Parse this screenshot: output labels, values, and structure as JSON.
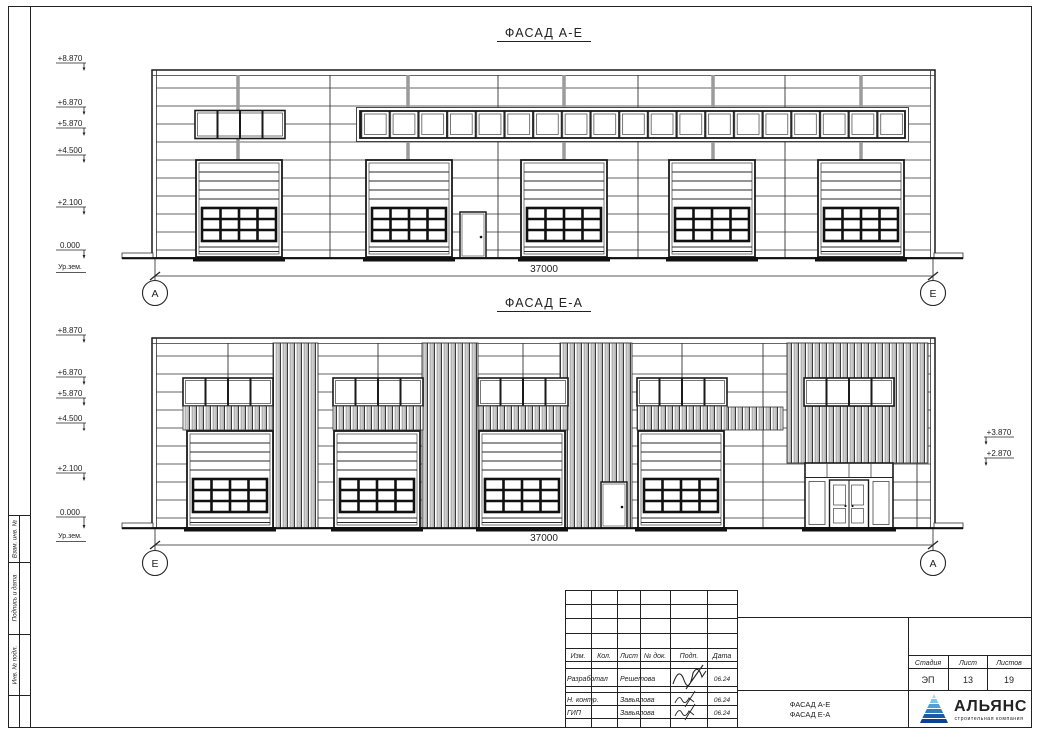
{
  "sheet": {
    "side_labels": [
      "Взам. инв. №",
      "Подпись и дата",
      "Инв. № подл."
    ]
  },
  "facade_top": {
    "title": "ФАСАД А-Е",
    "dimension": "37000",
    "axis_left": "А",
    "axis_right": "Е",
    "ground_label": "Ур.зем.",
    "marks": [
      "+8.870",
      "+6.870",
      "+5.870",
      "+4.500",
      "+2.100",
      "0.000"
    ]
  },
  "facade_bottom": {
    "title": "ФАСАД Е-А",
    "dimension": "37000",
    "axis_left": "Е",
    "axis_right": "А",
    "ground_label": "Ур.зем.",
    "marks": [
      "+8.870",
      "+6.870",
      "+5.870",
      "+4.500",
      "+2.100",
      "0.000"
    ],
    "right_marks": [
      "+3.870",
      "+2.870"
    ]
  },
  "title_block": {
    "header": [
      "Изм.",
      "Кол.",
      "Лист",
      "№ док.",
      "Подп.",
      "Дата"
    ],
    "rows": [
      {
        "role": "Разработал",
        "name": "Решетова",
        "date": "06.24"
      },
      {
        "role": "Н. контр.",
        "name": "Завьялова",
        "date": "06.24"
      },
      {
        "role": "ГИП",
        "name": "Завьялова",
        "date": "06.24"
      }
    ],
    "doc_name_line1": "ФАСАД А-Е",
    "doc_name_line2": "ФАСАД Е-А",
    "stage_header": [
      "Стадия",
      "Лист",
      "Листов"
    ],
    "stage_values": [
      "ЭП",
      "13",
      "19"
    ],
    "logo": {
      "name": "АЛЬЯНС",
      "subtitle": "строительная компания"
    }
  },
  "colors": {
    "line": "#222222",
    "mullion": "#9b9b9b",
    "logo_primary": "#1e3e8e",
    "logo_accent": "#2e7ac8"
  }
}
